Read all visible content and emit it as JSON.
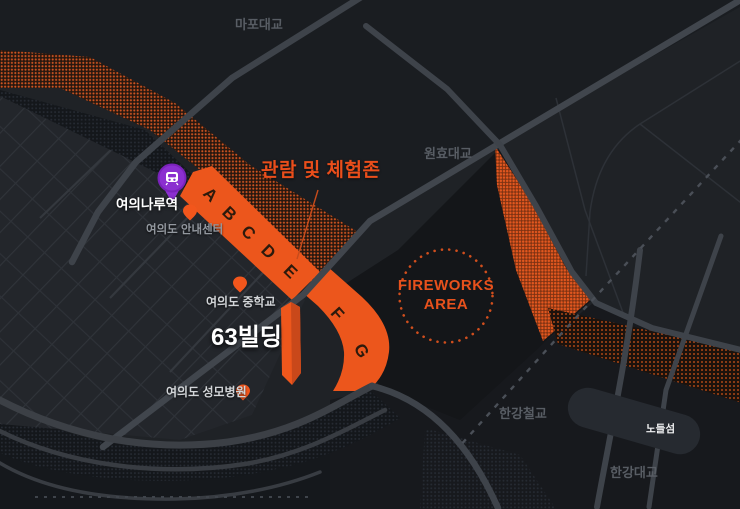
{
  "map": {
    "bridges": {
      "mapo": "마포대교",
      "wonhyo": "원효대교",
      "rail": "한강철교",
      "hangang": "한강대교"
    },
    "island_label": "노들섬",
    "pois": {
      "station": {
        "label": "여의나루역"
      },
      "info_center": {
        "label": "여의도 안내센터"
      },
      "middle_school": {
        "label": "여의도 중학교"
      },
      "building63": {
        "label": "63빌딩"
      },
      "hospital": {
        "label": "여의도 성모병원"
      }
    },
    "zone": {
      "title": "관람 및 체험존",
      "letters": [
        "A",
        "B",
        "C",
        "D",
        "E",
        "F",
        "G"
      ]
    },
    "fireworks": {
      "line1": "FIREWORKS",
      "line2": "AREA"
    },
    "colors": {
      "accent_orange": "#ec561c",
      "zone_letter": "#2d1a0c",
      "station_purple": "#8b2fd0",
      "bridge_label_gray": "#585d64",
      "background": "#1f2226"
    }
  }
}
